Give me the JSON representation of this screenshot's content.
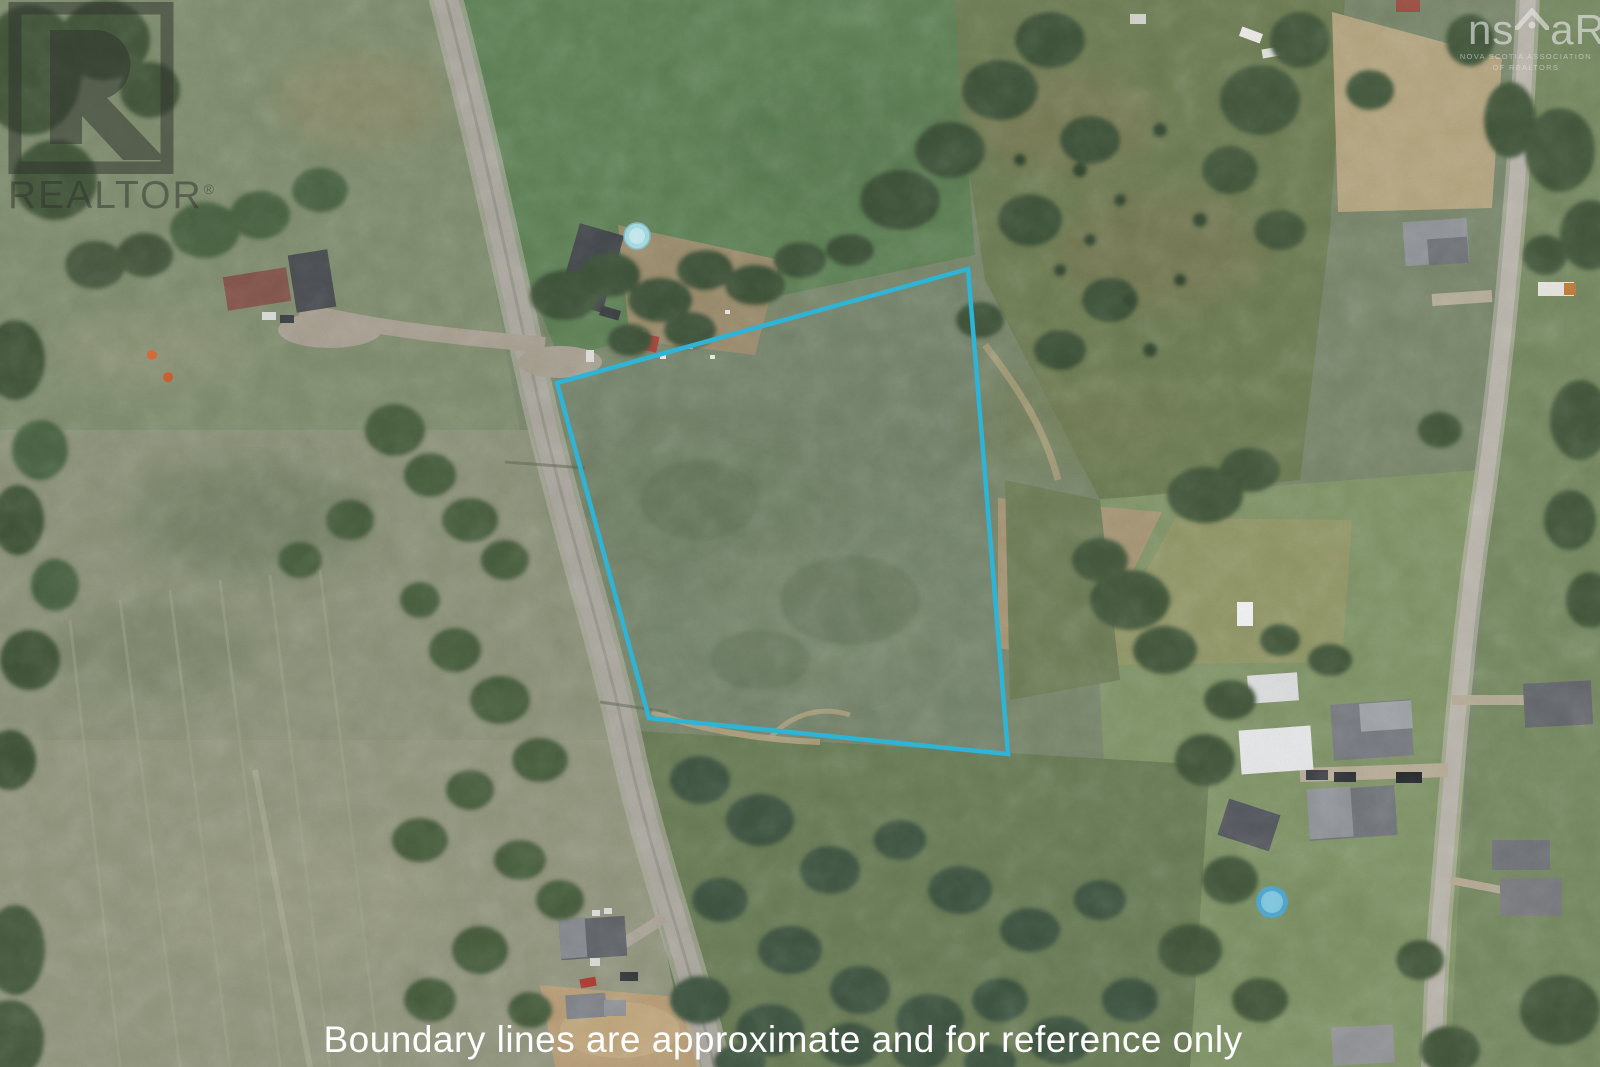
{
  "watermarks": {
    "realtor": {
      "name": "REALTOR",
      "registered": "®"
    },
    "nsar": {
      "prefix": "ns",
      "suffix": "aR",
      "subtext1": "NOVA SCOTIA ASSOCIATION",
      "subtext2": "OF REALTORS"
    }
  },
  "caption": {
    "text": "Boundary lines are approximate and for reference only"
  },
  "boundary": {
    "points": "968,269 557,383 649,718 1008,754",
    "color": "#2eb4d6",
    "stroke_width": "4.5"
  }
}
